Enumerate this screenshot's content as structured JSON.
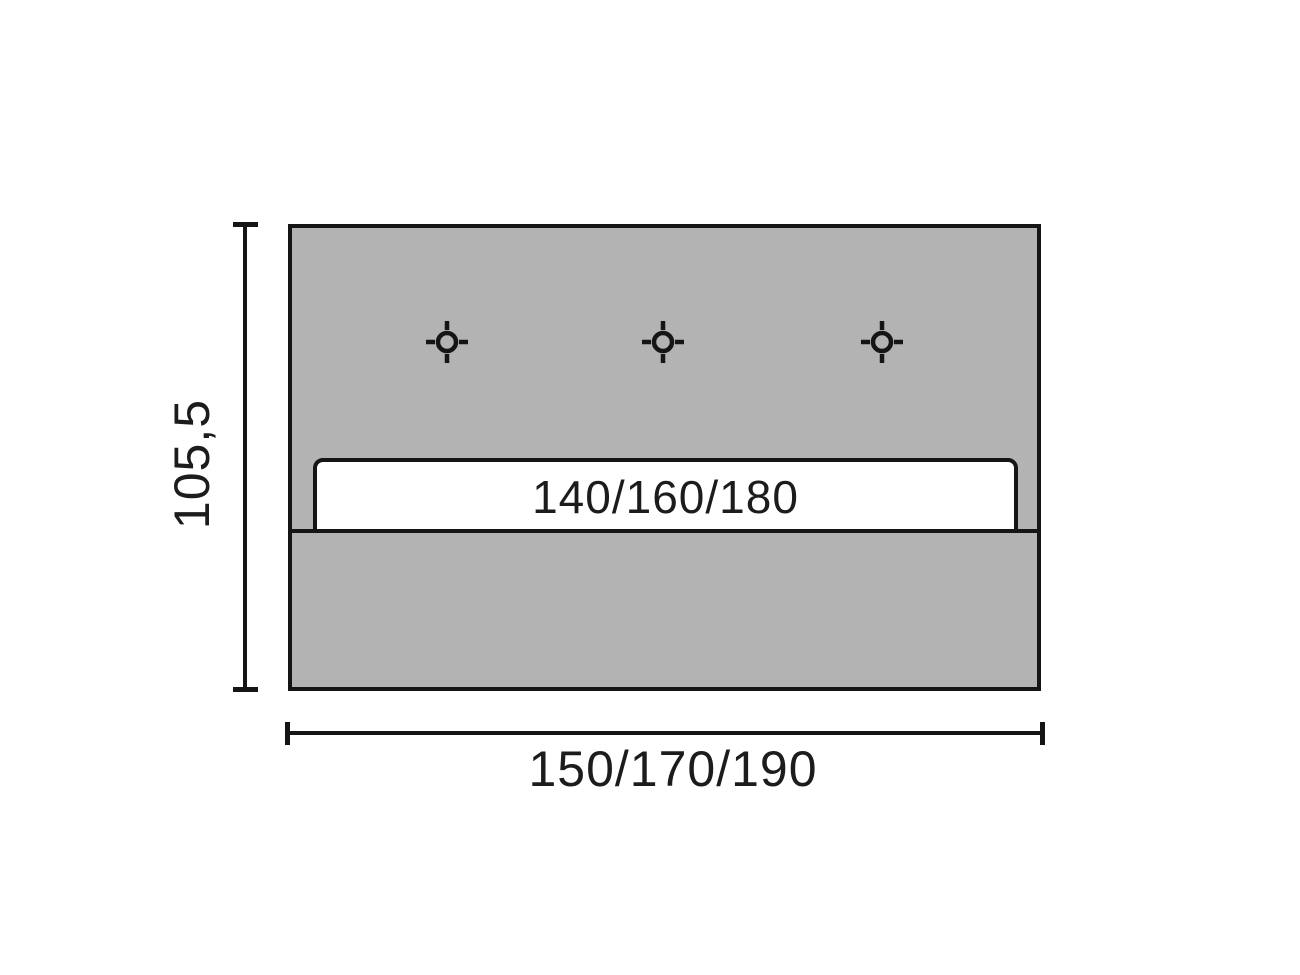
{
  "diagram": {
    "type": "technical-dimension-drawing",
    "labels": {
      "height": "105,5",
      "width": "150/170/190",
      "inner_width": "140/160/180"
    },
    "markers": {
      "icon": "crosshair-target-icon",
      "count": 3
    },
    "colors": {
      "background": "#ffffff",
      "panel_fill": "#b3b3b3",
      "bar_fill": "#ffffff",
      "outline": "#151515",
      "text": "#1c1c1c"
    }
  }
}
